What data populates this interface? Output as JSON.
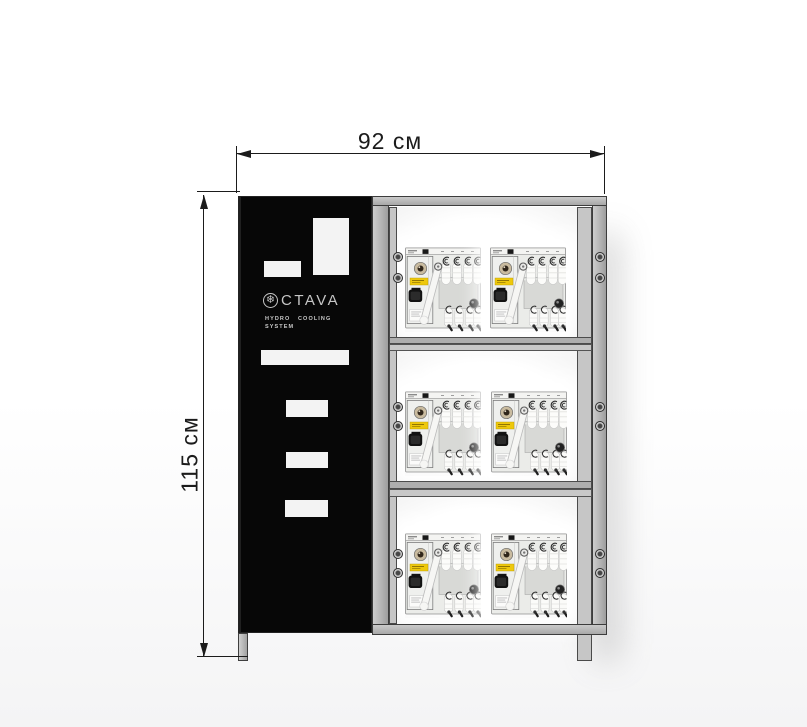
{
  "drawing": {
    "type": "product-dimension-diagram",
    "dimensions": {
      "width_label": "92 см",
      "height_label": "115 см"
    },
    "cabinet": {
      "brand": "OCTAVA",
      "brand_display": "CTAVA",
      "logo_icon": "snowflake-icon",
      "tagline_line1": "HYDRO COOLING",
      "tagline_line2": "SYSTEM",
      "shelves": 3,
      "units_per_shelf": 2,
      "total_units": 6
    },
    "colors": {
      "panel_black": "#070707",
      "frame_gray": "#b5b5b5",
      "frame_outline": "#3c3c3c",
      "unit_body": "#ebece9",
      "unit_label_yellow": "#eec80c",
      "dimension_ink": "#1b1b1b",
      "logo_gray": "#c6c6c6",
      "background": "#ffffff"
    }
  }
}
